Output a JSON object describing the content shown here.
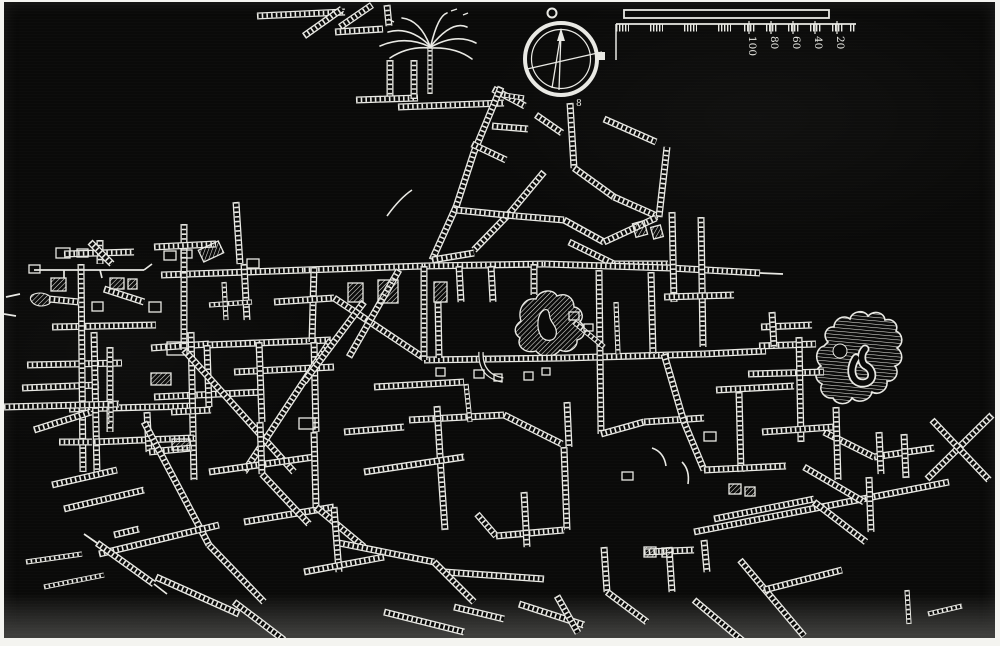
{
  "figure": {
    "description": "Engraved white-on-black plan of a network of subterranean passages (hatched ladder-style galleries), with a compass rose and a graduated scale bar at top",
    "canvas": {
      "width": 991,
      "height": 636
    },
    "colors": {
      "paper": "#f4f4f0",
      "plate": "#0a0a09",
      "ink": "#e9e9e4",
      "ink_dim": "#c8c8c2"
    }
  },
  "compass": {
    "cx": 557,
    "cy": 57,
    "outer_r": 36,
    "outer_w": 4,
    "inner_r": 29.5,
    "ring_cx": 548,
    "ring_cy": 11,
    "ring_r": 4.5,
    "knob": {
      "x": 592,
      "y": 50,
      "w": 9,
      "h": 8
    },
    "needle": [
      [
        557,
        31,
        555,
        88
      ],
      [
        557,
        31,
        548,
        86
      ]
    ],
    "arrow": "553,39 561,39 557,26",
    "cross": [
      523,
      67,
      598,
      50
    ],
    "glyph": "8",
    "glyph_x": 572,
    "glyph_y": 104
  },
  "scale_bar": {
    "bar": {
      "x": 620,
      "y": 8,
      "w": 205,
      "h": 8
    },
    "baseline": {
      "x1": 612,
      "x2": 852,
      "y": 22
    },
    "drop": {
      "x": 612,
      "y1": 22,
      "y2": 58
    },
    "blocks": [
      [
        612,
        13
      ],
      [
        646,
        13
      ],
      [
        680,
        13
      ],
      [
        714,
        13
      ],
      [
        740,
        11
      ],
      [
        762,
        11
      ],
      [
        784,
        11
      ],
      [
        806,
        11
      ],
      [
        828,
        11
      ],
      [
        846,
        6
      ]
    ],
    "ticks": [
      745,
      767,
      789,
      811,
      833
    ],
    "labels": [
      {
        "text": "100",
        "x": 745
      },
      {
        "text": "80",
        "x": 767
      },
      {
        "text": "60",
        "x": 789
      },
      {
        "text": "40",
        "x": 811
      },
      {
        "text": "20",
        "x": 833
      }
    ],
    "label_y": 34
  },
  "palm": {
    "trunk": [
      426,
      92,
      426,
      46
    ],
    "fronds": [
      [
        426,
        44,
        406,
        24,
        384,
        30
      ],
      [
        426,
        45,
        402,
        33,
        376,
        44
      ],
      [
        426,
        46,
        404,
        44,
        386,
        56
      ],
      [
        426,
        44,
        416,
        18,
        398,
        16
      ],
      [
        427,
        44,
        448,
        18,
        463,
        25
      ],
      [
        427,
        45,
        452,
        31,
        472,
        41
      ],
      [
        427,
        46,
        452,
        45,
        468,
        57
      ],
      [
        427,
        43,
        434,
        14,
        443,
        11
      ]
    ],
    "ticks": [
      [
        447,
        9,
        453,
        7
      ],
      [
        459,
        13,
        464,
        11
      ],
      [
        390,
        20,
        384,
        17
      ]
    ]
  },
  "map": {
    "ladders": [
      [
        253,
        14,
        341,
        10
      ],
      [
        300,
        34,
        338,
        7
      ],
      [
        336,
        25,
        368,
        3
      ],
      [
        383,
        3,
        385,
        24
      ],
      [
        331,
        30,
        379,
        27
      ],
      [
        386,
        58,
        386,
        99
      ],
      [
        352,
        98,
        414,
        96
      ],
      [
        410,
        58,
        410,
        97
      ],
      [
        394,
        105,
        500,
        101
      ],
      [
        489,
        87,
        521,
        104
      ],
      [
        497,
        85,
        470,
        150
      ],
      [
        470,
        150,
        452,
        205
      ],
      [
        452,
        205,
        428,
        258
      ],
      [
        566,
        101,
        570,
        166
      ],
      [
        532,
        113,
        558,
        131
      ],
      [
        488,
        124,
        524,
        127
      ],
      [
        600,
        117,
        652,
        140
      ],
      [
        468,
        142,
        502,
        158
      ],
      [
        570,
        166,
        610,
        195
      ],
      [
        610,
        195,
        655,
        215
      ],
      [
        540,
        170,
        505,
        212
      ],
      [
        505,
        212,
        470,
        248
      ],
      [
        452,
        208,
        512,
        214
      ],
      [
        512,
        214,
        560,
        218
      ],
      [
        560,
        218,
        600,
        240
      ],
      [
        600,
        240,
        652,
        216
      ],
      [
        655,
        215,
        663,
        145
      ],
      [
        565,
        240,
        610,
        262
      ],
      [
        610,
        262,
        664,
        262
      ],
      [
        428,
        258,
        470,
        251
      ],
      [
        157,
        273,
        300,
        268
      ],
      [
        300,
        268,
        420,
        264
      ],
      [
        420,
        264,
        540,
        262
      ],
      [
        540,
        262,
        666,
        266
      ],
      [
        666,
        266,
        756,
        271
      ],
      [
        147,
        346,
        205,
        342
      ],
      [
        203,
        343,
        327,
        338
      ],
      [
        230,
        370,
        330,
        365
      ],
      [
        150,
        395,
        260,
        390
      ],
      [
        420,
        358,
        560,
        356
      ],
      [
        560,
        356,
        700,
        352
      ],
      [
        700,
        352,
        762,
        349
      ],
      [
        180,
        222,
        180,
        270
      ],
      [
        150,
        245,
        212,
        242
      ],
      [
        232,
        200,
        236,
        262
      ],
      [
        96,
        238,
        96,
        262
      ],
      [
        60,
        252,
        130,
        250
      ],
      [
        86,
        240,
        108,
        262
      ],
      [
        48,
        325,
        152,
        323
      ],
      [
        23,
        363,
        118,
        361
      ],
      [
        18,
        386,
        95,
        383
      ],
      [
        65,
        407,
        190,
        404
      ],
      [
        77,
        262,
        79,
        470
      ],
      [
        90,
        330,
        93,
        472
      ],
      [
        180,
        270,
        180,
        348
      ],
      [
        187,
        330,
        190,
        478
      ],
      [
        106,
        345,
        106,
        430
      ],
      [
        45,
        297,
        75,
        300
      ],
      [
        100,
        287,
        140,
        300
      ],
      [
        240,
        262,
        243,
        318
      ],
      [
        310,
        265,
        308,
        340
      ],
      [
        270,
        300,
        330,
        296
      ],
      [
        203,
        343,
        205,
        405
      ],
      [
        255,
        340,
        258,
        420
      ],
      [
        310,
        340,
        312,
        430
      ],
      [
        180,
        348,
        290,
        470
      ],
      [
        327,
        338,
        240,
        470
      ],
      [
        330,
        296,
        420,
        356
      ],
      [
        360,
        300,
        300,
        380
      ],
      [
        395,
        268,
        345,
        355
      ],
      [
        90,
        440,
        190,
        436
      ],
      [
        455,
        264,
        457,
        300
      ],
      [
        487,
        264,
        489,
        300
      ],
      [
        530,
        262,
        530,
        293
      ],
      [
        595,
        268,
        597,
        432
      ],
      [
        647,
        270,
        649,
        352
      ],
      [
        420,
        264,
        420,
        358
      ],
      [
        434,
        300,
        435,
        356
      ],
      [
        370,
        385,
        460,
        380
      ],
      [
        405,
        418,
        500,
        413
      ],
      [
        500,
        413,
        558,
        442
      ],
      [
        340,
        430,
        400,
        425
      ],
      [
        433,
        404,
        437,
        470
      ],
      [
        437,
        470,
        441,
        528
      ],
      [
        560,
        445,
        563,
        528
      ],
      [
        563,
        400,
        565,
        445
      ],
      [
        597,
        432,
        640,
        420
      ],
      [
        640,
        420,
        700,
        416
      ],
      [
        660,
        352,
        680,
        420
      ],
      [
        680,
        420,
        700,
        468
      ],
      [
        668,
        210,
        670,
        300
      ],
      [
        697,
        215,
        699,
        345
      ],
      [
        660,
        295,
        730,
        293
      ],
      [
        757,
        325,
        808,
        323
      ],
      [
        755,
        344,
        812,
        342
      ],
      [
        744,
        372,
        820,
        370
      ],
      [
        768,
        310,
        770,
        345
      ],
      [
        795,
        335,
        797,
        440
      ],
      [
        735,
        390,
        737,
        470
      ],
      [
        712,
        388,
        790,
        384
      ],
      [
        700,
        468,
        782,
        464
      ],
      [
        690,
        530,
        945,
        480
      ],
      [
        710,
        517,
        810,
        497
      ],
      [
        923,
        477,
        988,
        413
      ],
      [
        928,
        418,
        985,
        478
      ],
      [
        870,
        455,
        930,
        446
      ],
      [
        820,
        430,
        870,
        455
      ],
      [
        758,
        430,
        830,
        425
      ],
      [
        800,
        465,
        860,
        500
      ],
      [
        832,
        405,
        834,
        478
      ],
      [
        865,
        475,
        867,
        530
      ],
      [
        875,
        430,
        877,
        472
      ],
      [
        900,
        432,
        902,
        476
      ],
      [
        810,
        500,
        862,
        540
      ],
      [
        473,
        512,
        492,
        534
      ],
      [
        492,
        534,
        560,
        528
      ],
      [
        520,
        490,
        523,
        545
      ],
      [
        440,
        570,
        540,
        577
      ],
      [
        450,
        605,
        500,
        617
      ],
      [
        515,
        602,
        580,
        623
      ],
      [
        553,
        594,
        574,
        631
      ],
      [
        600,
        545,
        603,
        590
      ],
      [
        603,
        590,
        643,
        620
      ],
      [
        640,
        550,
        690,
        548
      ],
      [
        665,
        545,
        668,
        590
      ],
      [
        700,
        538,
        703,
        570
      ],
      [
        690,
        598,
        740,
        640
      ],
      [
        736,
        558,
        800,
        634
      ],
      [
        760,
        588,
        838,
        568
      ],
      [
        143,
        410,
        145,
        450
      ],
      [
        145,
        450,
        188,
        446
      ],
      [
        140,
        420,
        205,
        543
      ],
      [
        48,
        483,
        113,
        468
      ],
      [
        60,
        507,
        140,
        488
      ],
      [
        95,
        552,
        215,
        523
      ],
      [
        152,
        575,
        235,
        612
      ],
      [
        205,
        543,
        260,
        600
      ],
      [
        230,
        600,
        280,
        638
      ],
      [
        205,
        470,
        310,
        455
      ],
      [
        240,
        520,
        330,
        505
      ],
      [
        256,
        420,
        258,
        472
      ],
      [
        258,
        472,
        305,
        522
      ],
      [
        310,
        430,
        312,
        505
      ],
      [
        312,
        505,
        360,
        545
      ],
      [
        330,
        540,
        430,
        560
      ],
      [
        360,
        470,
        460,
        455
      ],
      [
        330,
        505,
        335,
        570
      ],
      [
        380,
        610,
        460,
        630
      ],
      [
        300,
        570,
        380,
        555
      ],
      [
        430,
        560,
        470,
        600
      ],
      [
        110,
        533,
        135,
        527
      ],
      [
        93,
        541,
        150,
        582
      ],
      [
        0,
        405,
        115,
        402
      ],
      [
        30,
        428,
        87,
        410
      ],
      [
        55,
        440,
        88,
        440
      ],
      [
        167,
        410,
        207,
        408
      ]
    ],
    "thin_ladders": [
      [
        924,
        612,
        958,
        604
      ],
      [
        903,
        588,
        905,
        622
      ],
      [
        22,
        560,
        78,
        552
      ],
      [
        40,
        585,
        100,
        573
      ],
      [
        500,
        93,
        520,
        96
      ],
      [
        205,
        303,
        248,
        300
      ],
      [
        220,
        280,
        222,
        318
      ],
      [
        612,
        300,
        614,
        352
      ],
      [
        570,
        320,
        600,
        345
      ],
      [
        462,
        382,
        466,
        420
      ],
      [
        107,
        400,
        107,
        422
      ]
    ],
    "lines": [
      [
        30,
        268,
        140,
        268
      ],
      [
        60,
        268,
        60,
        276
      ],
      [
        96,
        268,
        98,
        276
      ],
      [
        140,
        268,
        148,
        262
      ],
      [
        756,
        271,
        779,
        272
      ],
      [
        150,
        582,
        163,
        592
      ],
      [
        80,
        532,
        93,
        541
      ],
      [
        2,
        295,
        16,
        292
      ],
      [
        0,
        312,
        12,
        314
      ]
    ],
    "curves": [
      [
        383,
        214,
        396,
        196,
        408,
        188
      ],
      [
        648,
        446,
        660,
        450,
        662,
        464
      ],
      [
        678,
        460,
        686,
        468,
        684,
        482
      ]
    ],
    "tubes": [
      "M477,350 Q476,374 499,378"
    ],
    "chambers": [
      [
        52,
        246,
        14,
        10,
        0,
        0
      ],
      [
        73,
        247,
        11,
        8,
        0,
        0
      ],
      [
        160,
        249,
        12,
        9,
        0,
        0
      ],
      [
        177,
        248,
        11,
        8,
        0,
        0
      ],
      [
        25,
        263,
        11,
        8,
        0,
        0
      ],
      [
        47,
        276,
        15,
        13,
        0,
        1
      ],
      [
        106,
        276,
        14,
        11,
        0,
        1
      ],
      [
        124,
        277,
        9,
        10,
        0,
        1
      ],
      [
        88,
        300,
        11,
        9,
        0,
        0
      ],
      [
        145,
        300,
        12,
        10,
        0,
        0
      ],
      [
        163,
        340,
        20,
        13,
        0,
        0
      ],
      [
        147,
        371,
        20,
        12,
        0,
        1
      ],
      [
        168,
        437,
        18,
        11,
        0,
        1
      ],
      [
        295,
        416,
        16,
        11,
        0,
        0
      ],
      [
        196,
        243,
        22,
        13,
        -25,
        1
      ],
      [
        243,
        257,
        12,
        9,
        0,
        0
      ],
      [
        344,
        281,
        15,
        19,
        0,
        1
      ],
      [
        374,
        278,
        20,
        23,
        0,
        1
      ],
      [
        430,
        280,
        13,
        20,
        0,
        1
      ],
      [
        470,
        368,
        10,
        8,
        0,
        0
      ],
      [
        490,
        372,
        8,
        7,
        0,
        0
      ],
      [
        520,
        370,
        9,
        8,
        0,
        0
      ],
      [
        538,
        366,
        8,
        7,
        0,
        0
      ],
      [
        432,
        366,
        9,
        8,
        0,
        0
      ],
      [
        640,
        545,
        12,
        10,
        0,
        1
      ],
      [
        658,
        546,
        10,
        9,
        0,
        1
      ],
      [
        725,
        482,
        12,
        10,
        0,
        1
      ],
      [
        741,
        485,
        10,
        9,
        0,
        1
      ],
      [
        700,
        430,
        12,
        9,
        0,
        0
      ],
      [
        618,
        470,
        11,
        8,
        0,
        0
      ],
      [
        630,
        220,
        12,
        14,
        -15,
        1
      ],
      [
        648,
        224,
        10,
        12,
        -15,
        1
      ],
      [
        565,
        310,
        10,
        8,
        0,
        0
      ],
      [
        580,
        322,
        9,
        7,
        0,
        0
      ]
    ],
    "blobs": {
      "central": "M517,319 C513,307 521,295 532,297 C535,288 549,286 553,294 C562,290 570,296 570,305 C577,306 581,314 576,320 C583,325 582,336 573,338 C574,346 564,352 556,348 C550,356 537,356 532,349 C521,352 512,344 516,336 C509,331 510,324 517,319 Z",
      "central_inner": "M540,308 C533,312 532,326 537,334 C541,340 550,340 552,333 C554,326 548,322 546,316 C545,311 545,306 540,308 Z",
      "right": "M824,340 C818,334 822,324 830,325 C830,317 840,312 846,317 C848,309 860,307 864,314 C870,308 880,310 881,318 C888,316 895,322 892,329 C899,332 900,342 893,346 C900,351 899,362 891,364 C896,371 891,380 883,379 C884,388 875,394 868,390 C866,399 854,402 848,396 C844,404 832,403 829,396 C821,397 814,389 818,382 C810,378 810,368 817,364 C810,358 812,346 820,344 Z",
      "right_hole": {
        "cx": 836,
        "cy": 349,
        "r": 7
      },
      "right_channel": "M852,356 C844,368 848,382 860,381 C870,380 870,368 862,364 C857,362 856,352 861,347",
      "small_west": "M28,293 q8,-4 16,0 q6,4 1,9 q-8,4 -15,0 q-6,-5 -2,-9 Z"
    }
  }
}
